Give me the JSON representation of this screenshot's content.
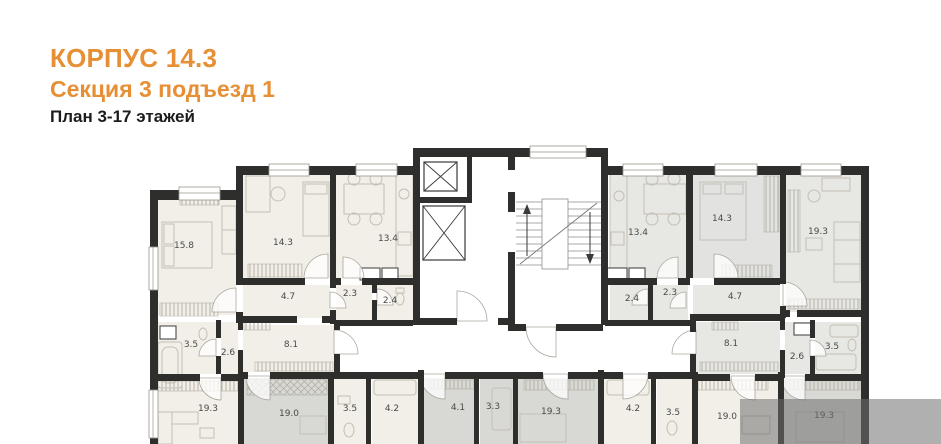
{
  "header": {
    "building": "КОРПУС 14.3",
    "section": "Секция 3 подъезд 1",
    "plan": "План 3-17 этажей"
  },
  "colors": {
    "accent_orange": "#E68F35",
    "title_dark": "#1C1C1C",
    "wall": "#2E2E2C",
    "floor_cream": "#F2EFE8",
    "floor_gray": "#E7E7E4",
    "floor_dark_gray": "#D8D8D5",
    "watermark": "#6F6F6F"
  },
  "rooms": [
    {
      "area": "15.8"
    },
    {
      "area": "14.3"
    },
    {
      "area": "13.4"
    },
    {
      "area": "4.7"
    },
    {
      "area": "2.3"
    },
    {
      "area": "2.4"
    },
    {
      "area": "3.5"
    },
    {
      "area": "2.6"
    },
    {
      "area": "8.1"
    },
    {
      "area": "19.3"
    },
    {
      "area": "19.0"
    },
    {
      "area": "3.5"
    },
    {
      "area": "4.2"
    },
    {
      "area": "4.1"
    },
    {
      "area": "3.3"
    },
    {
      "area": "19.3"
    },
    {
      "area": "4.2"
    },
    {
      "area": "3.5"
    },
    {
      "area": "19.0"
    },
    {
      "area": "19.3"
    },
    {
      "area": "13.4"
    },
    {
      "area": "14.3"
    },
    {
      "area": "19.3"
    },
    {
      "area": "2.4"
    },
    {
      "area": "2.3"
    },
    {
      "area": "4.7"
    },
    {
      "area": "8.1"
    },
    {
      "area": "2.6"
    },
    {
      "area": "3.5"
    }
  ]
}
